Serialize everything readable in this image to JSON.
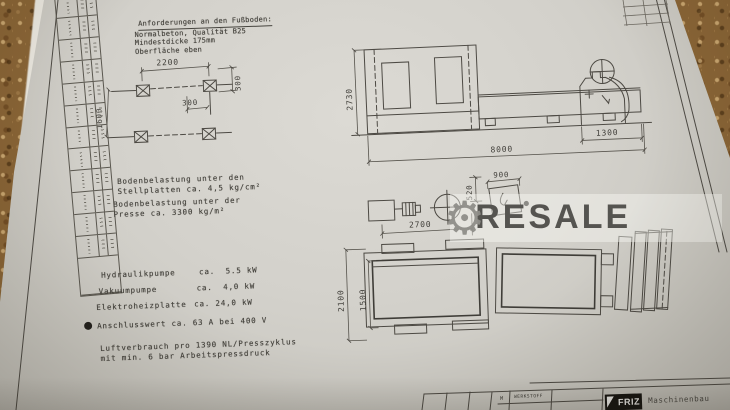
{
  "watermark": {
    "text": "RESALE",
    "accent_color": "#555450"
  },
  "notes": {
    "floor_title": "Anforderungen an den Fußboden:",
    "floor_line1": "Normalbeton, Qualität B25",
    "floor_line2": "Mindestdicke 175mm",
    "floor_line3": "Oberfläche eben",
    "load_plates_line1": "Bodenbelastung unter den",
    "load_plates_line2": "Stellplatten ca. 4,5 kg/cm²",
    "load_press_line1": "Bodenbelastung unter der",
    "load_press_line2": "Presse ca. 3300 kg/m²",
    "power": [
      {
        "label": "Hydraulikpumpe",
        "value": "ca.  5.5 kW"
      },
      {
        "label": "Vakuumpumpe",
        "value": "ca.  4,0 kW"
      },
      {
        "label": "Elektroheizplatte",
        "value": "ca. 24,0 kW"
      }
    ],
    "connection": "Anschlusswert ca. 63 A bei 400 V",
    "air_line1": "Luftverbrauch pro 1390 NL/Presszyklus",
    "air_line2": "mit min. 6 bar Arbeitspressdruck"
  },
  "dims": {
    "foundation": {
      "width": "2200",
      "depth": "1600",
      "offset_h": "300",
      "offset_v": "300"
    },
    "elevation": {
      "height": "2730",
      "total_length": "8000",
      "console": "1300"
    },
    "plan": {
      "press_length": "2700",
      "outer_depth": "2100",
      "platen_depth": "1500",
      "detail_width": "900",
      "detail_offset": "520"
    }
  },
  "titleblock": {
    "m": "M",
    "werkstoff": "WERKSTOFF",
    "logo": "FRIZ",
    "company": "Maschinenbau"
  }
}
